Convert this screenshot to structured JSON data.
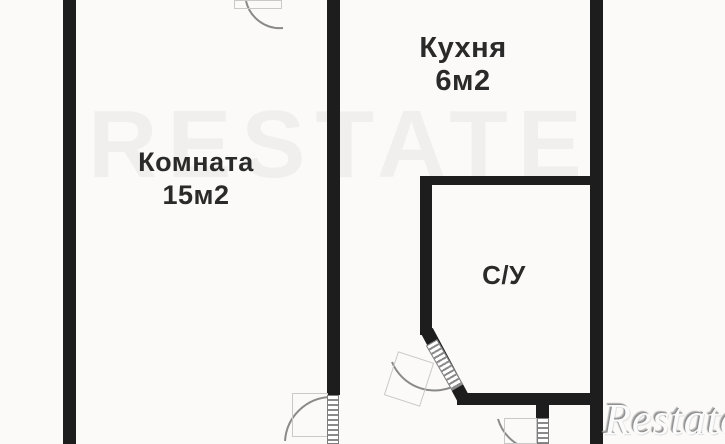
{
  "floor_plan": {
    "rooms": [
      {
        "name": "Комната",
        "area": "15м2"
      },
      {
        "name": "Кухня",
        "area": "6м2"
      },
      {
        "name": "С/У",
        "area": ""
      }
    ],
    "brand_watermark": "Restate",
    "ghost_watermark": "RESTATE",
    "colors": {
      "wall": "#1d1d1d",
      "background": "#fbfaf8",
      "label_text": "#2a2a2a",
      "door_symbol": "#8a8a8a",
      "door_ghost": "#c9c9c9",
      "brand_gray": "#9a9a9a"
    }
  }
}
